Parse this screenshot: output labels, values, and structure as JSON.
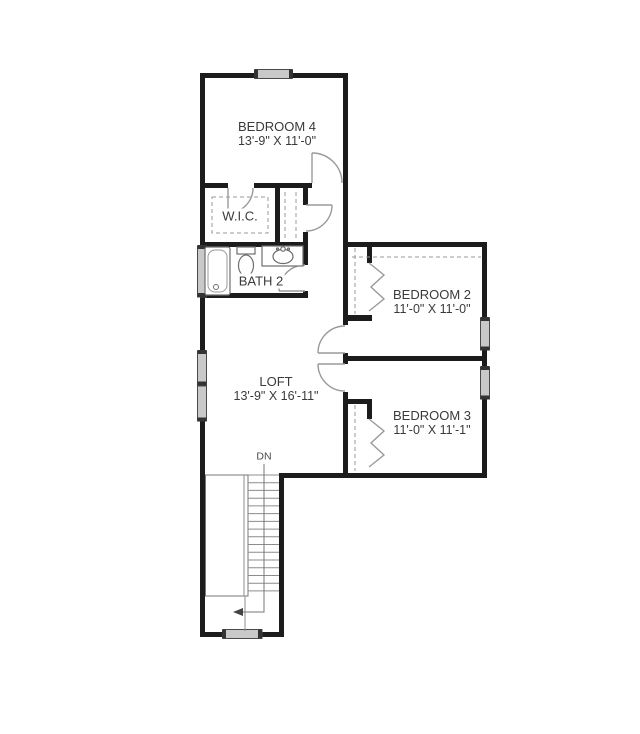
{
  "plan": {
    "type": "floor-plan",
    "colors": {
      "wall": "#1c1c1c",
      "door_line": "#9a9a9a",
      "fixture_line": "#6e6e6e",
      "dash_line": "#9a9a9a",
      "window_fill": "#c9c9c9",
      "window_cap": "#333333",
      "stair_line": "#8c8c8c",
      "label_text": "#3a3a3a",
      "background": "#ffffff"
    },
    "rooms": {
      "bedroom4": {
        "name": "BEDROOM 4",
        "dims": "13'-9\" X 11'-0\""
      },
      "wic": {
        "name": "W.I.C."
      },
      "bath2": {
        "name": "BATH 2"
      },
      "bedroom2": {
        "name": "BEDROOM 2",
        "dims": "11'-0\" X 11'-0\""
      },
      "bedroom3": {
        "name": "BEDROOM 3",
        "dims": "11'-0\" X 11'-1\""
      },
      "loft": {
        "name": "LOFT",
        "dims": "13'-9\" X 16'-11\""
      }
    },
    "stairs": {
      "label": "DN"
    },
    "fixtures": [
      {
        "id": "bathtub",
        "room": "BATH 2"
      },
      {
        "id": "toilet",
        "room": "BATH 2"
      },
      {
        "id": "sink-vanity",
        "room": "BATH 2"
      }
    ]
  }
}
